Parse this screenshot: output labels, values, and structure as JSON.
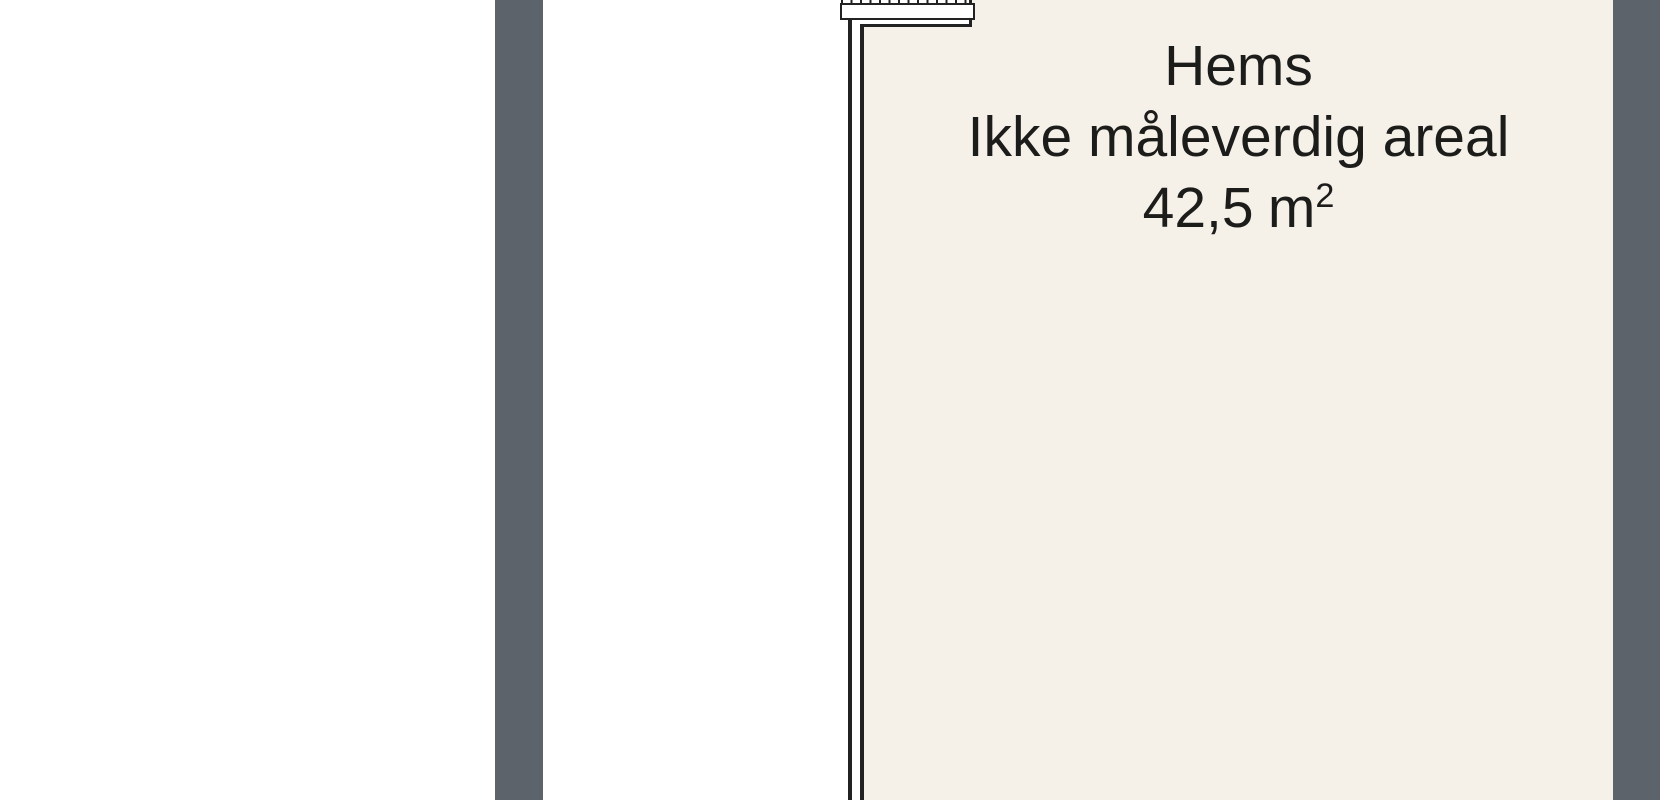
{
  "floorplan": {
    "room": {
      "name": "Hems",
      "note": "Ikke måleverdig areal",
      "area_value": "42,5",
      "area_unit": "m",
      "area_exponent": "2"
    },
    "elements": {
      "ladder_icon": "loft-ladder-hatched-bar",
      "left_bar": "thick-gray-wall",
      "right_bar": "thick-gray-wall"
    },
    "colors": {
      "wall_gray": "#5D636B",
      "room_fill": "#F5F1E9",
      "line_dark": "#222222",
      "background": "#FFFFFF",
      "text": "#1C1C1A"
    }
  }
}
